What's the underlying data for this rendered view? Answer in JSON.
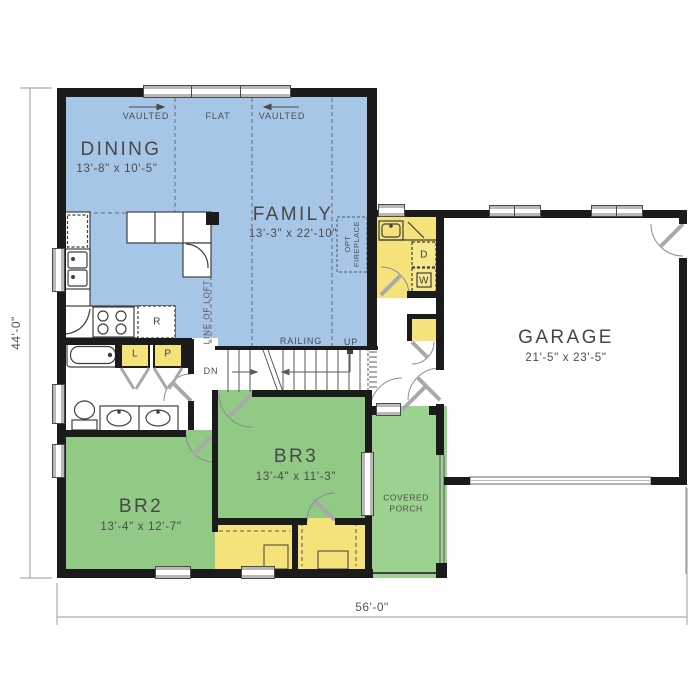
{
  "dimensions": {
    "overall_width": "56'-0\"",
    "overall_depth": "44'-0\""
  },
  "rooms": {
    "dining": {
      "name": "DINING",
      "size": "13'-8\" x 10'-5\""
    },
    "family": {
      "name": "FAMILY",
      "size": "13'-3\" x 22'-10\""
    },
    "garage": {
      "name": "GARAGE",
      "size": "21'-5\" x 23'-5\""
    },
    "br2": {
      "name": "BR2",
      "size": "13'-4\" x 12'-7\""
    },
    "br3": {
      "name": "BR3",
      "size": "13'-4\" x 11'-3\""
    },
    "covered_porch": {
      "line1": "COVERED",
      "line2": "PORCH"
    }
  },
  "ceiling": {
    "vaulted_left": "VAULTED",
    "flat": "FLAT",
    "vaulted_right": "VAULTED"
  },
  "stairs": {
    "railing": "RAILING",
    "up": "UP",
    "down": "DN"
  },
  "notes": {
    "line_of_loft": "LINE OF LOFT",
    "opt_fireplace_line1": "OPT",
    "opt_fireplace_line2": "FIREPLACE"
  },
  "appliances": {
    "refrigerator": "R",
    "linen": "L",
    "pantry": "P",
    "dryer": "D",
    "washer": "W"
  },
  "colors": {
    "living": "#a6c6e7",
    "bedroom": "#90ca85",
    "porch": "#9bd28f",
    "storage": "#f5e27b",
    "wall": "#1b1b1b"
  }
}
